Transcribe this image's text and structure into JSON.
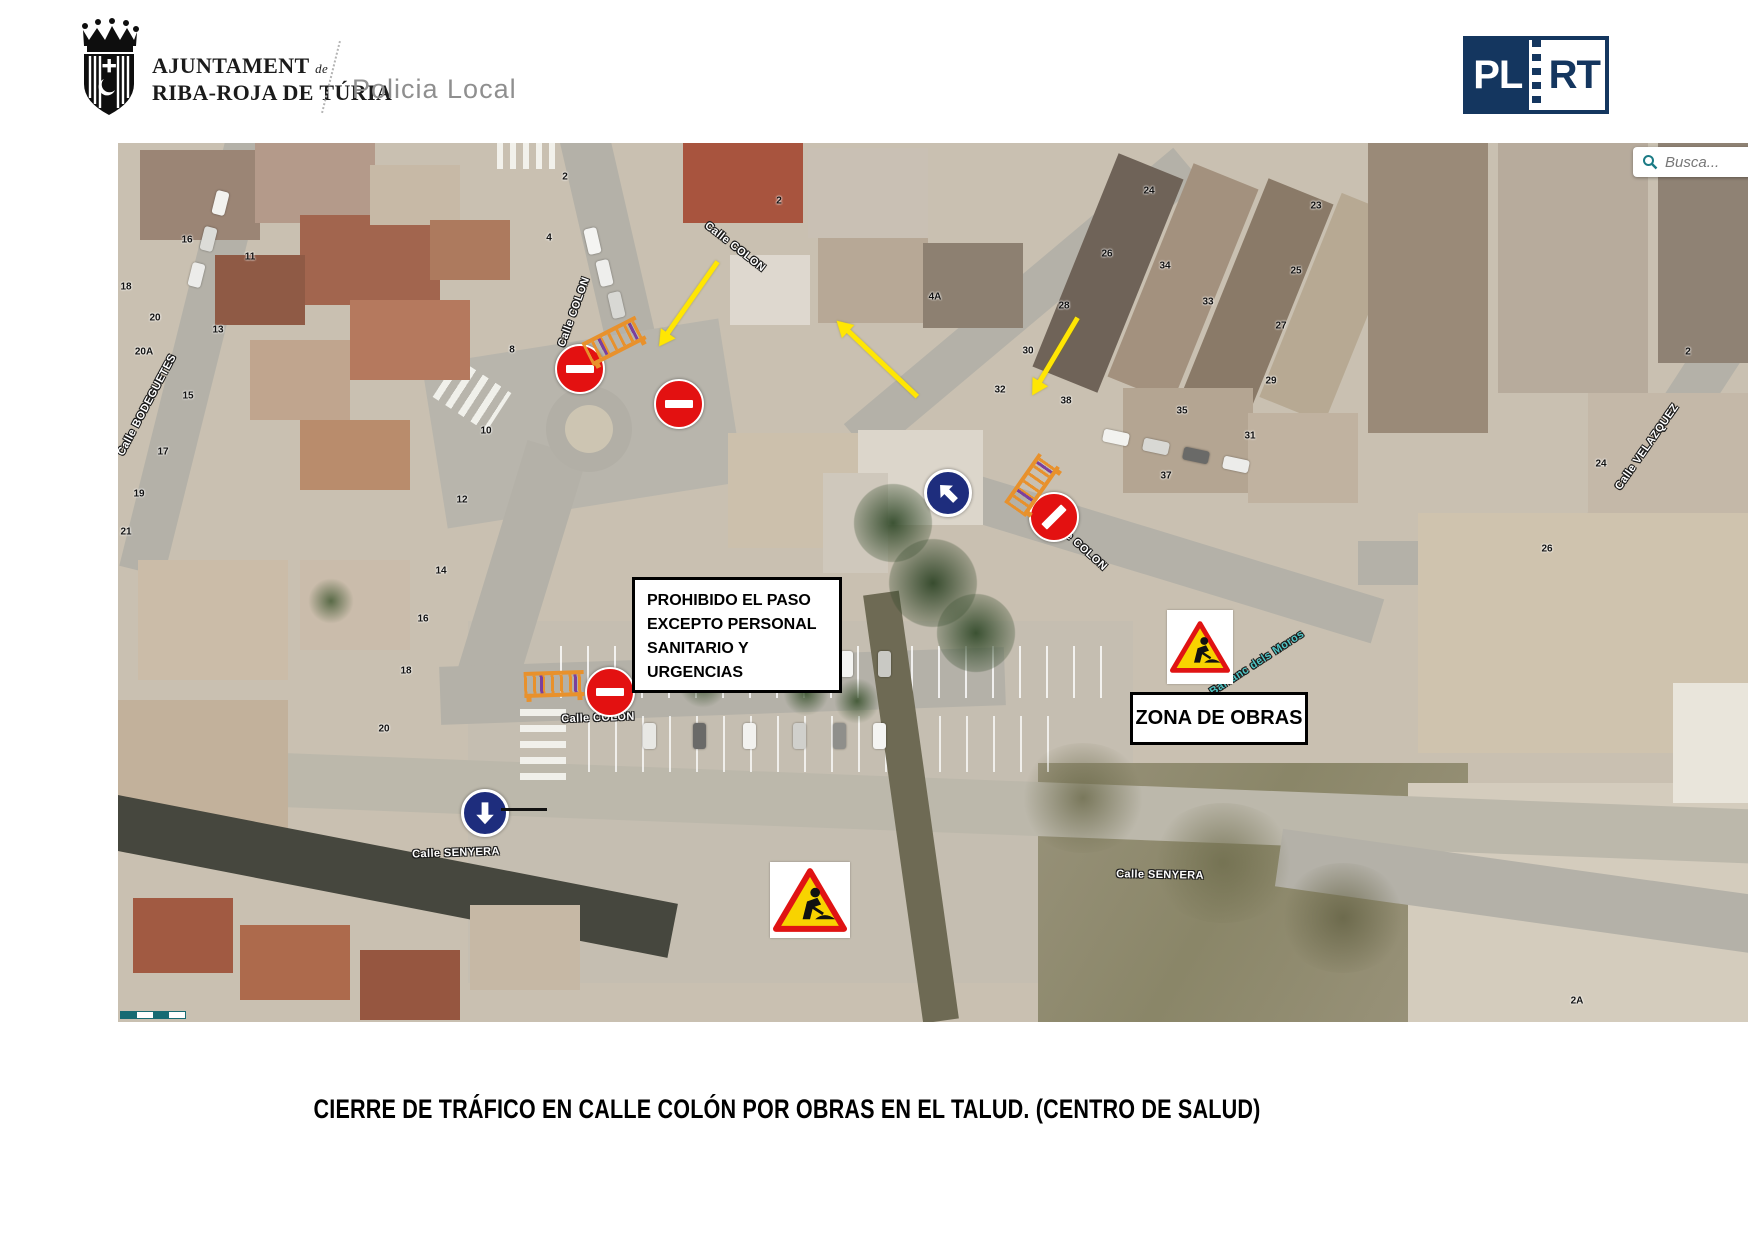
{
  "header": {
    "org_name_line1": "AJUNTAMENT",
    "org_name_de": "de",
    "org_name_line2": "RIBA-ROJA DE TÚRIA",
    "department": "Policia Local"
  },
  "brand_logo": {
    "left_text": "PL",
    "right_text": "RT",
    "color": "#14365f"
  },
  "map": {
    "search_placeholder": "Busca...",
    "boxes": {
      "prohibido": "PROHIBIDO EL PASO EXCEPTO PERSONAL SANITARIO Y URGENCIAS",
      "zona_obras": "ZONA DE OBRAS"
    },
    "street_labels": [
      {
        "text": "Calle COLON",
        "x": 456,
        "y": 169,
        "rot": -70
      },
      {
        "text": "Calle COLON",
        "x": 617,
        "y": 104,
        "rot": 38
      },
      {
        "text": "Calle COLON",
        "x": 960,
        "y": 401,
        "rot": 42
      },
      {
        "text": "Calle COLON",
        "x": 480,
        "y": 575,
        "rot": -2
      },
      {
        "text": "Calle SENYERA",
        "x": 338,
        "y": 710,
        "rot": -2
      },
      {
        "text": "Calle SENYERA",
        "x": 1042,
        "y": 732,
        "rot": 1
      },
      {
        "text": "Calle BODEGUETES",
        "x": 29,
        "y": 262,
        "rot": -62
      },
      {
        "text": "Calle VELAZQUEZ",
        "x": 1529,
        "y": 304,
        "rot": -55
      },
      {
        "text": "Barranc dels Moros",
        "x": 1139,
        "y": 520,
        "rot": -33,
        "teal": true
      }
    ],
    "house_numbers": [
      {
        "t": "16",
        "x": 69,
        "y": 97
      },
      {
        "t": "11",
        "x": 132,
        "y": 114
      },
      {
        "t": "18",
        "x": 8,
        "y": 144
      },
      {
        "t": "20",
        "x": 37,
        "y": 175
      },
      {
        "t": "20A",
        "x": 26,
        "y": 209
      },
      {
        "t": "13",
        "x": 100,
        "y": 187
      },
      {
        "t": "15",
        "x": 70,
        "y": 253
      },
      {
        "t": "17",
        "x": 45,
        "y": 309
      },
      {
        "t": "19",
        "x": 21,
        "y": 351
      },
      {
        "t": "21",
        "x": 8,
        "y": 389
      },
      {
        "t": "2",
        "x": 447,
        "y": 34
      },
      {
        "t": "4",
        "x": 431,
        "y": 95
      },
      {
        "t": "8",
        "x": 394,
        "y": 207
      },
      {
        "t": "10",
        "x": 368,
        "y": 288
      },
      {
        "t": "12",
        "x": 344,
        "y": 357
      },
      {
        "t": "14",
        "x": 323,
        "y": 428
      },
      {
        "t": "16",
        "x": 305,
        "y": 476
      },
      {
        "t": "18",
        "x": 288,
        "y": 528
      },
      {
        "t": "20",
        "x": 266,
        "y": 586
      },
      {
        "t": "2",
        "x": 661,
        "y": 58
      },
      {
        "t": "4A",
        "x": 817,
        "y": 154
      },
      {
        "t": "24",
        "x": 1031,
        "y": 48
      },
      {
        "t": "23",
        "x": 1198,
        "y": 63
      },
      {
        "t": "26",
        "x": 989,
        "y": 111
      },
      {
        "t": "34",
        "x": 1047,
        "y": 123
      },
      {
        "t": "25",
        "x": 1178,
        "y": 128
      },
      {
        "t": "28",
        "x": 946,
        "y": 163
      },
      {
        "t": "33",
        "x": 1090,
        "y": 159
      },
      {
        "t": "27",
        "x": 1163,
        "y": 183
      },
      {
        "t": "30",
        "x": 910,
        "y": 208
      },
      {
        "t": "29",
        "x": 1153,
        "y": 238
      },
      {
        "t": "32",
        "x": 882,
        "y": 247
      },
      {
        "t": "38",
        "x": 948,
        "y": 258
      },
      {
        "t": "35",
        "x": 1064,
        "y": 268
      },
      {
        "t": "31",
        "x": 1132,
        "y": 293
      },
      {
        "t": "37",
        "x": 1048,
        "y": 333
      },
      {
        "t": "24",
        "x": 1483,
        "y": 321
      },
      {
        "t": "26",
        "x": 1429,
        "y": 406
      },
      {
        "t": "2",
        "x": 1570,
        "y": 209
      },
      {
        "t": "2A",
        "x": 1459,
        "y": 858
      }
    ],
    "signs": [
      {
        "type": "no_entry",
        "x": 460,
        "y": 224,
        "bar_rot": 0
      },
      {
        "type": "no_entry",
        "x": 559,
        "y": 259,
        "bar_rot": 0
      },
      {
        "type": "no_entry",
        "x": 934,
        "y": 372,
        "bar_rot": -45
      },
      {
        "type": "no_entry",
        "x": 490,
        "y": 547,
        "bar_rot": 0
      },
      {
        "type": "mandatory_arrow",
        "x": 827,
        "y": 347,
        "rot": -45
      },
      {
        "type": "mandatory_arrow",
        "x": 364,
        "y": 667,
        "rot": 180,
        "pointer_line": true
      },
      {
        "type": "works",
        "x": 692,
        "y": 757,
        "w": 80,
        "h": 76
      },
      {
        "type": "works",
        "x": 1082,
        "y": 504,
        "w": 66,
        "h": 74
      },
      {
        "type": "barrier",
        "x": 496,
        "y": 198,
        "rot": -27
      },
      {
        "type": "barrier",
        "x": 914,
        "y": 342,
        "rot": -55
      },
      {
        "type": "barrier",
        "x": 436,
        "y": 541,
        "rot": -2
      }
    ],
    "arrows": [
      {
        "x1": 600,
        "y1": 119,
        "x2": 542,
        "y2": 202
      },
      {
        "x1": 799,
        "y1": 254,
        "x2": 720,
        "y2": 179
      },
      {
        "x1": 960,
        "y1": 175,
        "x2": 915,
        "y2": 251
      }
    ]
  },
  "caption": "CIERRE DE TRÁFICO EN CALLE COLÓN POR OBRAS EN EL TALUD. (CENTRO DE SALUD)"
}
